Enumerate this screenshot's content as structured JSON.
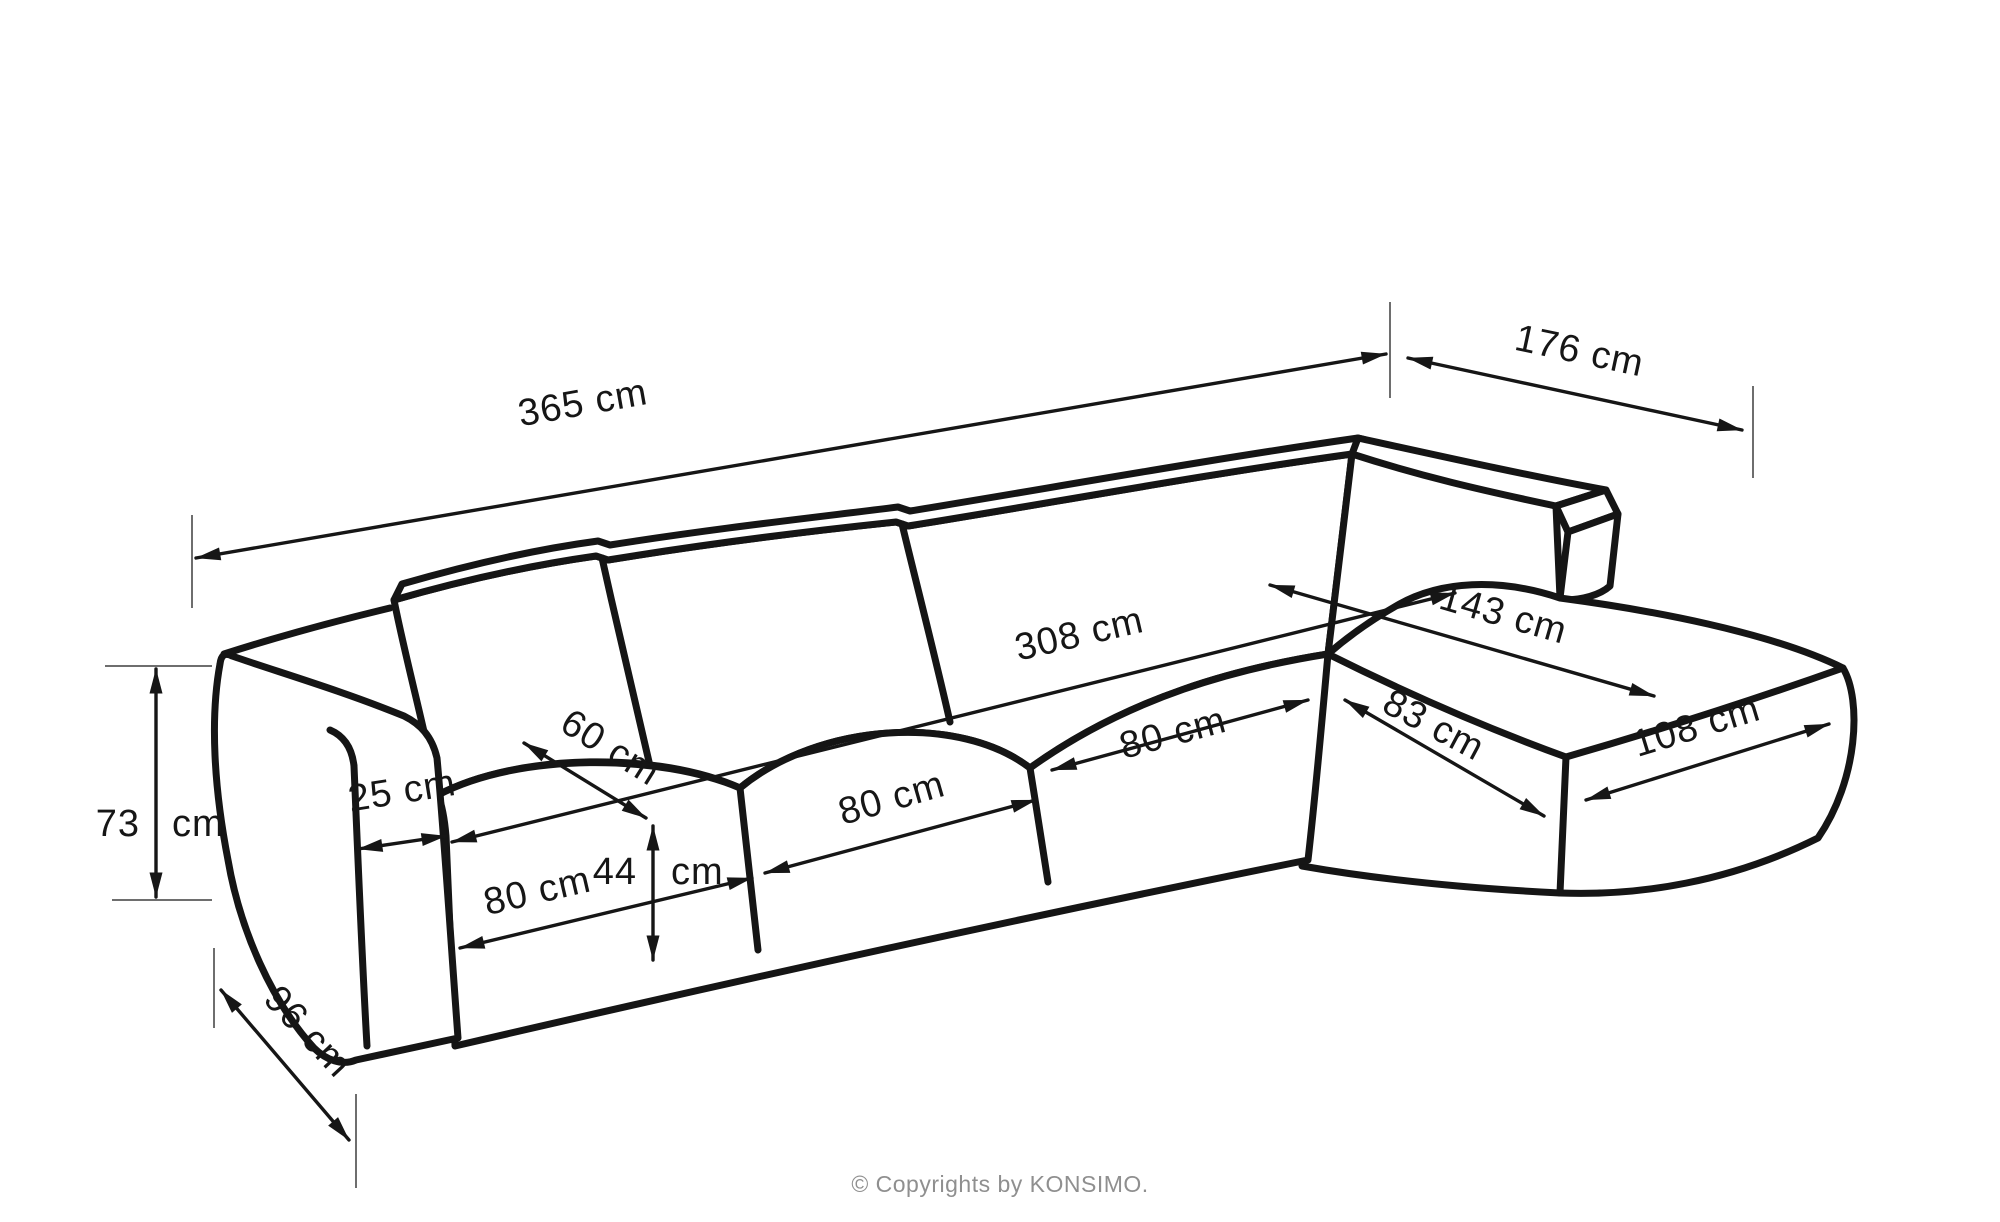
{
  "diagram": {
    "kind": "furniture-dimension-line-drawing",
    "subject": "corner-sofa-with-chaise",
    "units": "cm",
    "colors": {
      "background": "#ffffff",
      "outline": "#151515",
      "dimension_line": "#161616",
      "extension_line": "#6e6e6e",
      "footer_text": "#8f8f8f"
    },
    "dimensions": [
      {
        "id": "overall-width",
        "label": "365 cm",
        "value": 365
      },
      {
        "id": "chaise-side-width",
        "label": "176 cm",
        "value": 176
      },
      {
        "id": "inner-seat-span",
        "label": "308 cm",
        "value": 308
      },
      {
        "id": "chaise-diagonal",
        "label": "143 cm",
        "value": 143
      },
      {
        "id": "seat-depth",
        "label": "60 cm",
        "value": 60
      },
      {
        "id": "armrest-width",
        "label": "25 cm",
        "value": 25
      },
      {
        "id": "seat-module-1",
        "label": "80 cm",
        "value": 80
      },
      {
        "id": "seat-module-2",
        "label": "80 cm",
        "value": 80
      },
      {
        "id": "seat-module-3",
        "label": "80 cm",
        "value": 80
      },
      {
        "id": "seat-height",
        "label": "44 cm",
        "value": 44,
        "num": "44",
        "unit": "cm"
      },
      {
        "id": "overall-height",
        "label": "73 cm",
        "value": 73,
        "num": "73",
        "unit": "cm"
      },
      {
        "id": "base-depth",
        "label": "96 cm",
        "value": 96
      },
      {
        "id": "chaise-inner-width",
        "label": "83 cm",
        "value": 83
      },
      {
        "id": "chaise-outer-width",
        "label": "108 cm",
        "value": 108
      }
    ],
    "footer": {
      "copyright": "© Copyrights by KONSIMO."
    }
  }
}
